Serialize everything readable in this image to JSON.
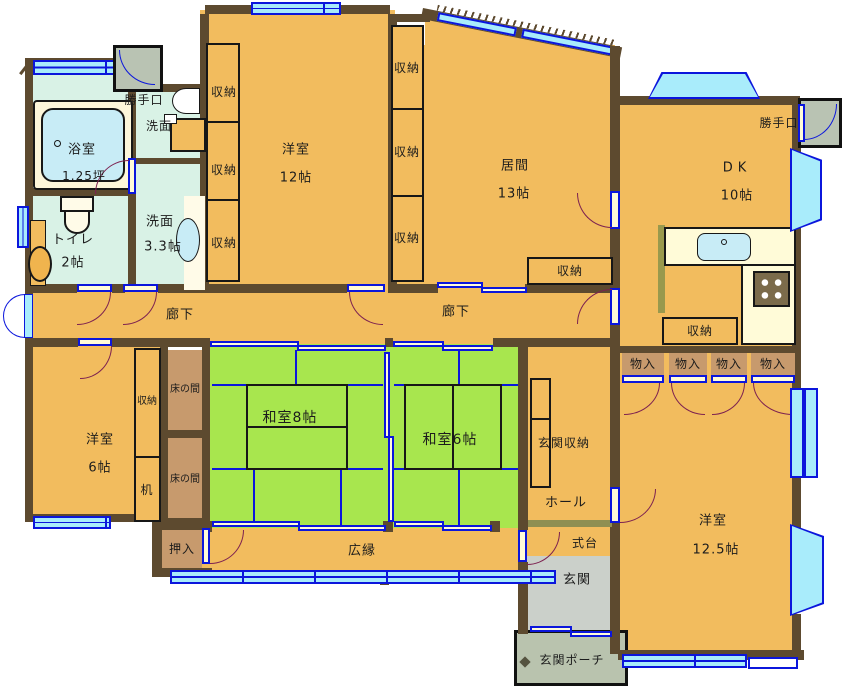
{
  "plan": {
    "title": "house-floor-plan",
    "rooms": {
      "bath": {
        "name": "浴室",
        "size": "1.25坪"
      },
      "wash_top": {
        "name": "洗面"
      },
      "toilet": {
        "name": "トイレ",
        "size": "2帖"
      },
      "wash": {
        "name": "洗面",
        "size": "3.3帖"
      },
      "western12": {
        "name": "洋室",
        "size": "12帖"
      },
      "living": {
        "name": "居間",
        "size": "13帖"
      },
      "dk": {
        "name": "DK",
        "size": "10帖"
      },
      "corridor": {
        "name": "廊下"
      },
      "western6": {
        "name": "洋室",
        "size": "6帖"
      },
      "japanese8": {
        "name": "和室8帖"
      },
      "japanese6": {
        "name": "和室6帖"
      },
      "veranda": {
        "name": "広縁"
      },
      "western125": {
        "name": "洋室",
        "size": "12.5帖"
      },
      "hall": {
        "name": "ホール"
      },
      "step": {
        "name": "式台"
      },
      "entrance": {
        "name": "玄関"
      },
      "porch": {
        "name": "玄関ポーチ"
      },
      "entrance_storage": {
        "name": "玄関収納"
      },
      "futon_closet": {
        "name": "押入"
      },
      "alcove": {
        "name": "床の間"
      },
      "desk": {
        "name": "机"
      }
    },
    "labels": {
      "storage": "収納",
      "closet": "物入",
      "back_door": "勝手口"
    },
    "colors": {
      "wall": "#5d4a2f",
      "room_floor": "#f2bc5e",
      "tatami": "#a8e64e",
      "wet_room": "#d9f2e6",
      "window_glass": "#a9ecfb",
      "window_frame": "#0b16dc",
      "closet_brown": "#c79a6d",
      "entrance_floor": "#cbd0ca",
      "porch_floor": "#b9c3ae",
      "counter": "#fffbd8",
      "door_swing": "#7d2150"
    }
  }
}
